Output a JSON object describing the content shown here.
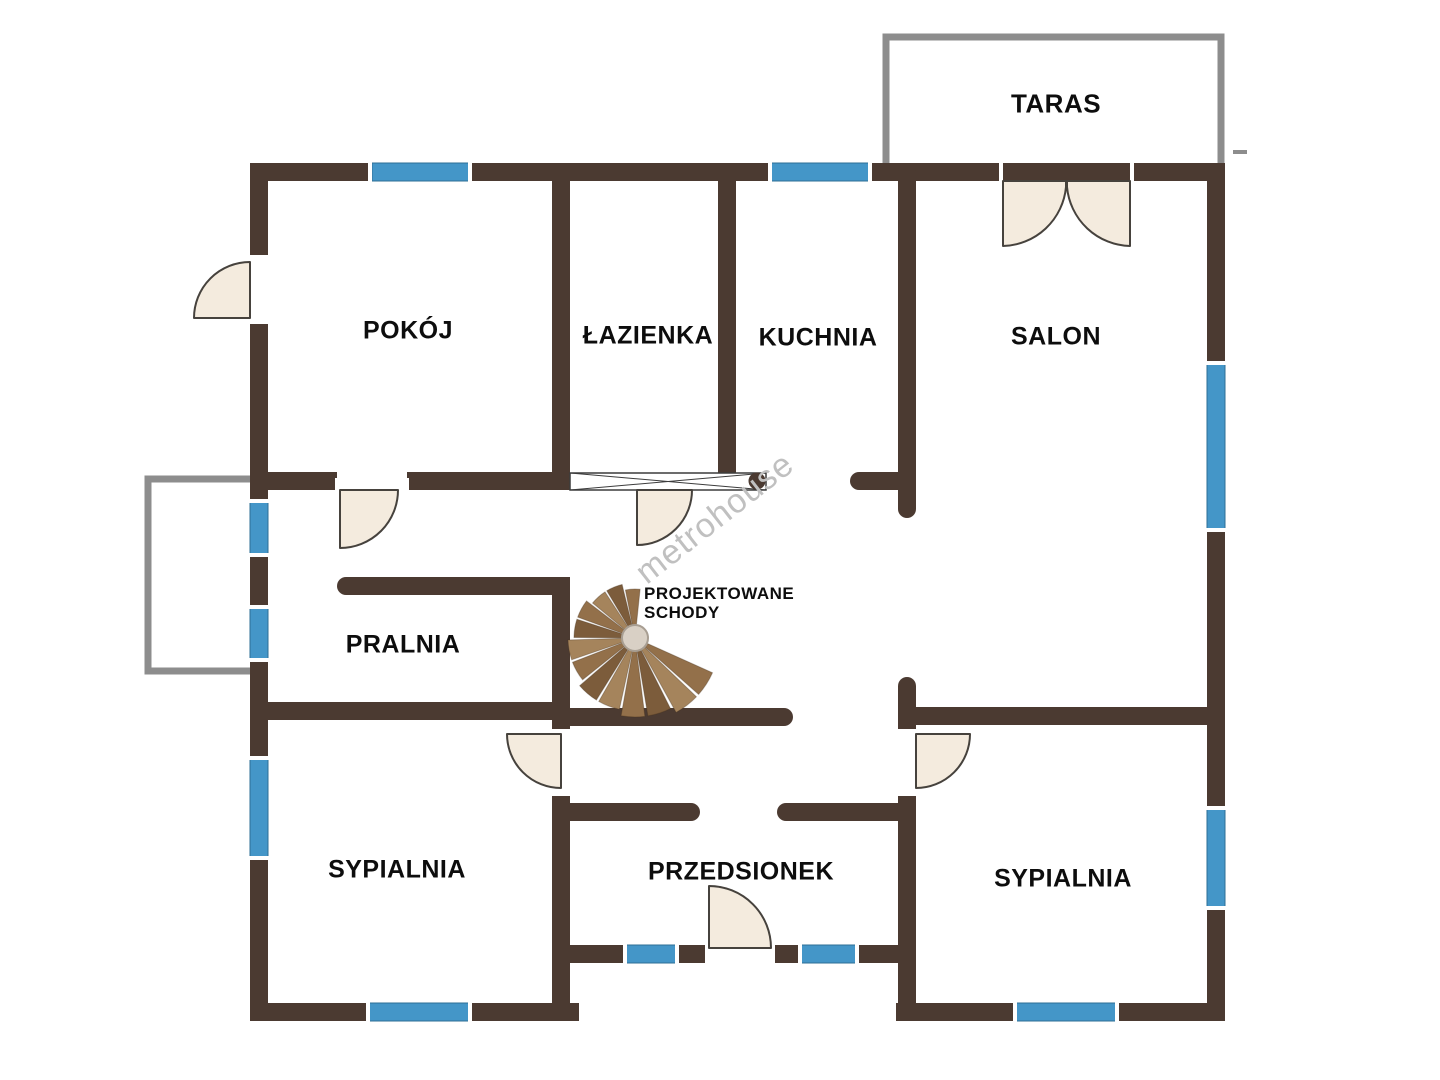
{
  "rooms": {
    "taras": {
      "label": "TARAS"
    },
    "pokoj": {
      "label": "POKÓJ"
    },
    "lazienka": {
      "label": "ŁAZIENKA"
    },
    "kuchnia": {
      "label": "KUCHNIA"
    },
    "salon": {
      "label": "SALON"
    },
    "pralnia": {
      "label": "PRALNIA"
    },
    "sypialnia_lewa": {
      "label": "SYPIALNIA"
    },
    "przedsionek": {
      "label": "PRZEDSIONEK"
    },
    "sypialnia_prawa": {
      "label": "SYPIALNIA"
    }
  },
  "stairs": {
    "label": "PROJEKTOWANE SCHODY",
    "lines": [
      "PROJEKTOWANE",
      "SCHODY"
    ]
  },
  "watermark": {
    "text": "metrohouse"
  },
  "colors": {
    "bg": "#ffffff",
    "wall": "#4b3a31",
    "window": "#4496c8",
    "window_edge": "#2e6f96",
    "door_fill": "#f4ebde",
    "door_stroke": "#46423d",
    "outline": "#8d8d8d",
    "hatch": "#3c3c3c",
    "stair_dark": "#7c5c3b",
    "stair_mid": "#93704a",
    "stair_light": "#a5845c",
    "stair_hub": "#d9d0c5",
    "stair_hub_edge": "#a89e92",
    "label": "#0d0d0d",
    "watermark": "#c0c0c0"
  }
}
